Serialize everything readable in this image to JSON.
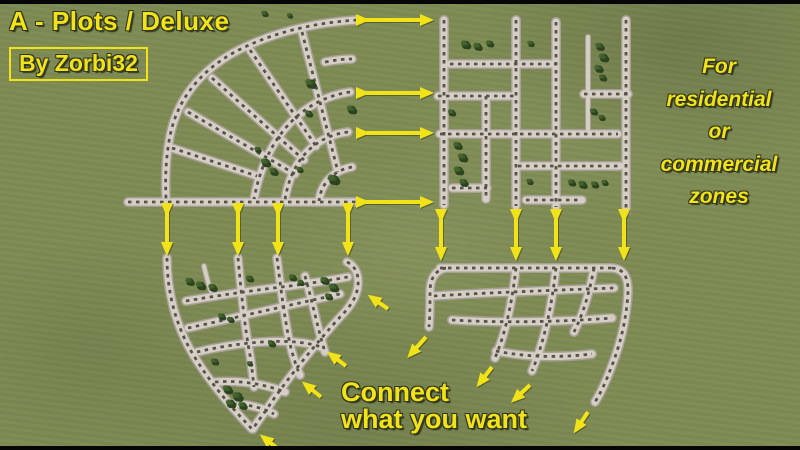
{
  "title": "A - Plots / Deluxe",
  "byline": "By Zorbi32",
  "note": {
    "lines": [
      "For",
      "residential",
      "or",
      "commercial",
      "zones"
    ]
  },
  "connect": {
    "line1": "Connect",
    "line2": "what you want"
  },
  "colors": {
    "background": "#7e8b54",
    "letterbox": "#060606",
    "yellow": "#f2e318",
    "shadow": "#31361f",
    "road_surface": "#d6cfc6",
    "road_edge": "#a8a096",
    "road_marks": "#3f3d35",
    "tree_dark": "#2c431f",
    "tree_light": "#44662e"
  }
}
